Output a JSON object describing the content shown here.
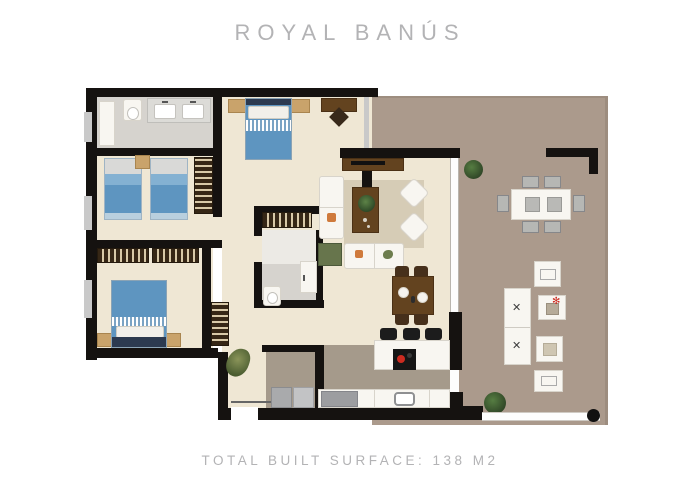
{
  "header": {
    "title": "ROYAL BANÚS"
  },
  "footer": {
    "caption": "TOTAL BUILT SURFACE: 138 M2"
  },
  "palette": {
    "background": "#ffffff",
    "wall": "#151210",
    "window": "#c9c9c9",
    "interior_floor": "#efe7d4",
    "terrace_floor": "#ab9a8c",
    "kitchen_floor": "#a59a8b",
    "bathroom_floor": "#d6d3ce",
    "rug": "#d6ccb6",
    "bed_blue": "#5e95c0",
    "bed_blue_light": "#84b1d2",
    "navy": "#2c3a50",
    "wood_dark": "#63431f",
    "wood_light": "#c9a36b",
    "closet_dark": "#362716",
    "white_furniture": "#f8f6f1",
    "gray_furniture": "#9d9e9f",
    "plant_green": "#2f4526",
    "accent_red": "#cc2b20",
    "armchair_green": "#67754c",
    "text_gray": "#b3b3b5"
  },
  "glyphs": {
    "lounger_x": "✕",
    "plant_sprig": "✻"
  }
}
